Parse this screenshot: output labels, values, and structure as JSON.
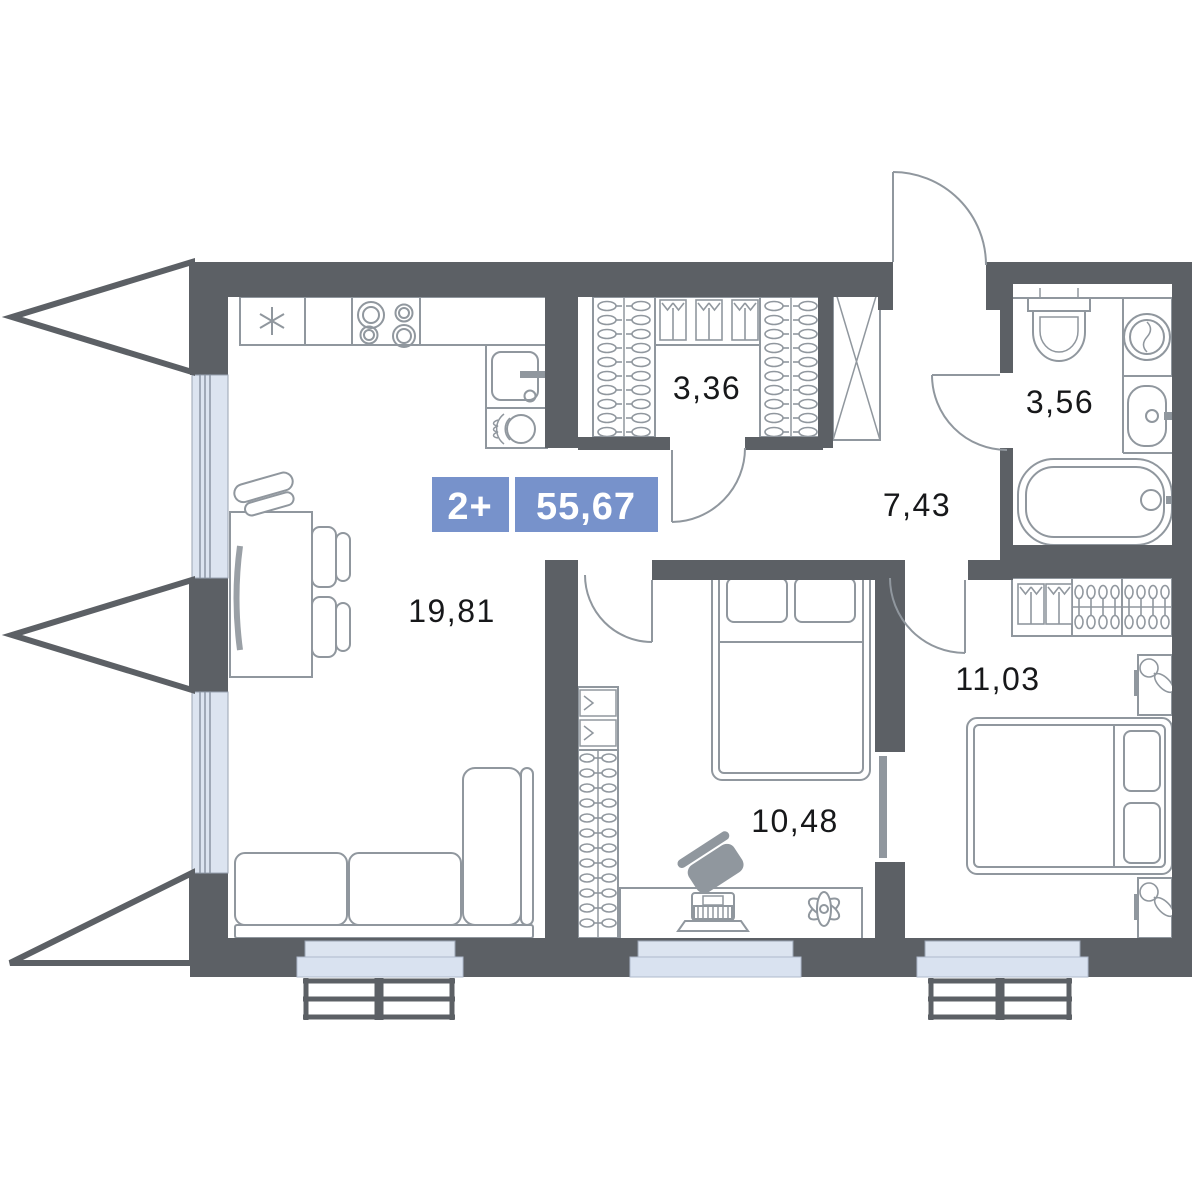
{
  "plan": {
    "type_badge": {
      "rooms": "2+",
      "total_area": "55,67"
    },
    "rooms": [
      {
        "name": "living-kitchen",
        "area": "19,81"
      },
      {
        "name": "wardrobe",
        "area": "3,36"
      },
      {
        "name": "bathroom",
        "area": "3,56"
      },
      {
        "name": "hallway",
        "area": "7,43"
      },
      {
        "name": "bedroom",
        "area": "10,48"
      },
      {
        "name": "bedroom-2",
        "area": "11,03"
      }
    ],
    "colors": {
      "wall": "#5c6065",
      "accent": "#7792cb",
      "window": "#dce4f0",
      "sill": "#d9e2f0",
      "line": "#90979e",
      "label": "#17181a"
    }
  }
}
